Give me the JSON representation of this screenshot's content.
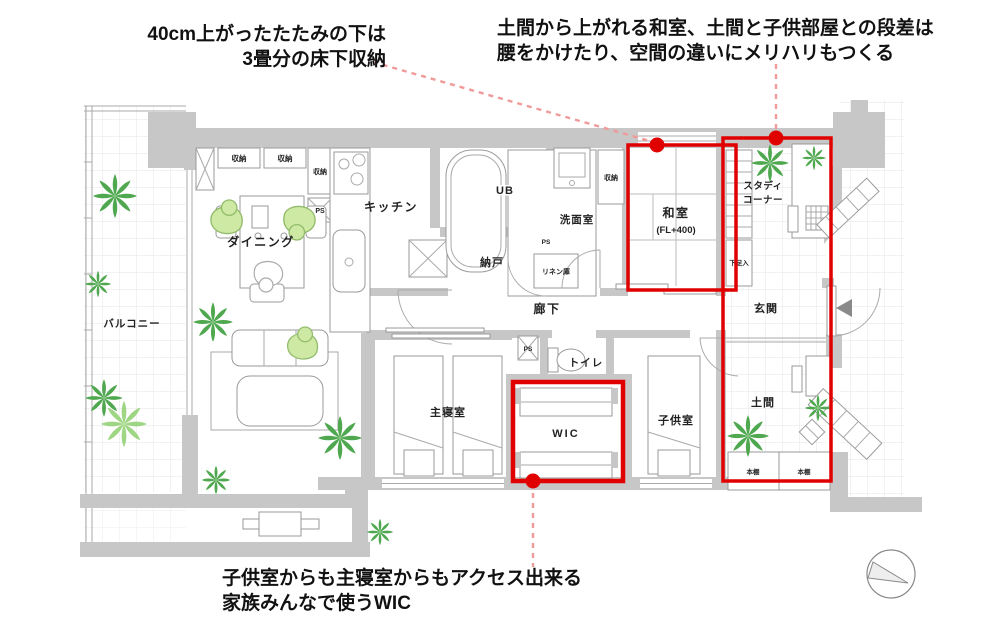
{
  "annotations": {
    "tatami": {
      "line1": "40cm上がったたたみの下は",
      "line2": "3畳分の床下収納"
    },
    "doma": {
      "line1": "土間から上がれる和室、土間と子供部屋との段差は",
      "line2": "腰をかけたり、空間の違いにメリハリもつくる"
    },
    "wic": {
      "line1": "子供室からも主寝室からもアクセス出来る",
      "line2": "家族みんなで使うWIC"
    }
  },
  "rooms": {
    "balcony": "バルコニー",
    "dining": "ダイニング",
    "kitchen": "キッチン",
    "living": "リビング",
    "ub": "UB",
    "washroom": "洗面室",
    "nando": "納戸",
    "linen": "リネン庫",
    "hallway": "廊下",
    "washitsu": "和室",
    "washitsu_fl": "(FL+400)",
    "storage": "収納",
    "ps": "PS",
    "shoes": "下足入",
    "study1": "スタディ",
    "study2": "コーナー",
    "genkan": "玄関",
    "doma": "土間",
    "shelf": "本棚",
    "master": "主寝室",
    "wic_label": "WIC",
    "kids": "子供室",
    "toilet": "トイレ"
  },
  "colors": {
    "highlight": "#e00000",
    "leader": "#f09a9a",
    "wall": "#c7c7c7",
    "plantdark": "#4fa84f",
    "plantlight": "#8fcf6f",
    "person": "#cde9a4",
    "tri": "#8a8a8a"
  }
}
